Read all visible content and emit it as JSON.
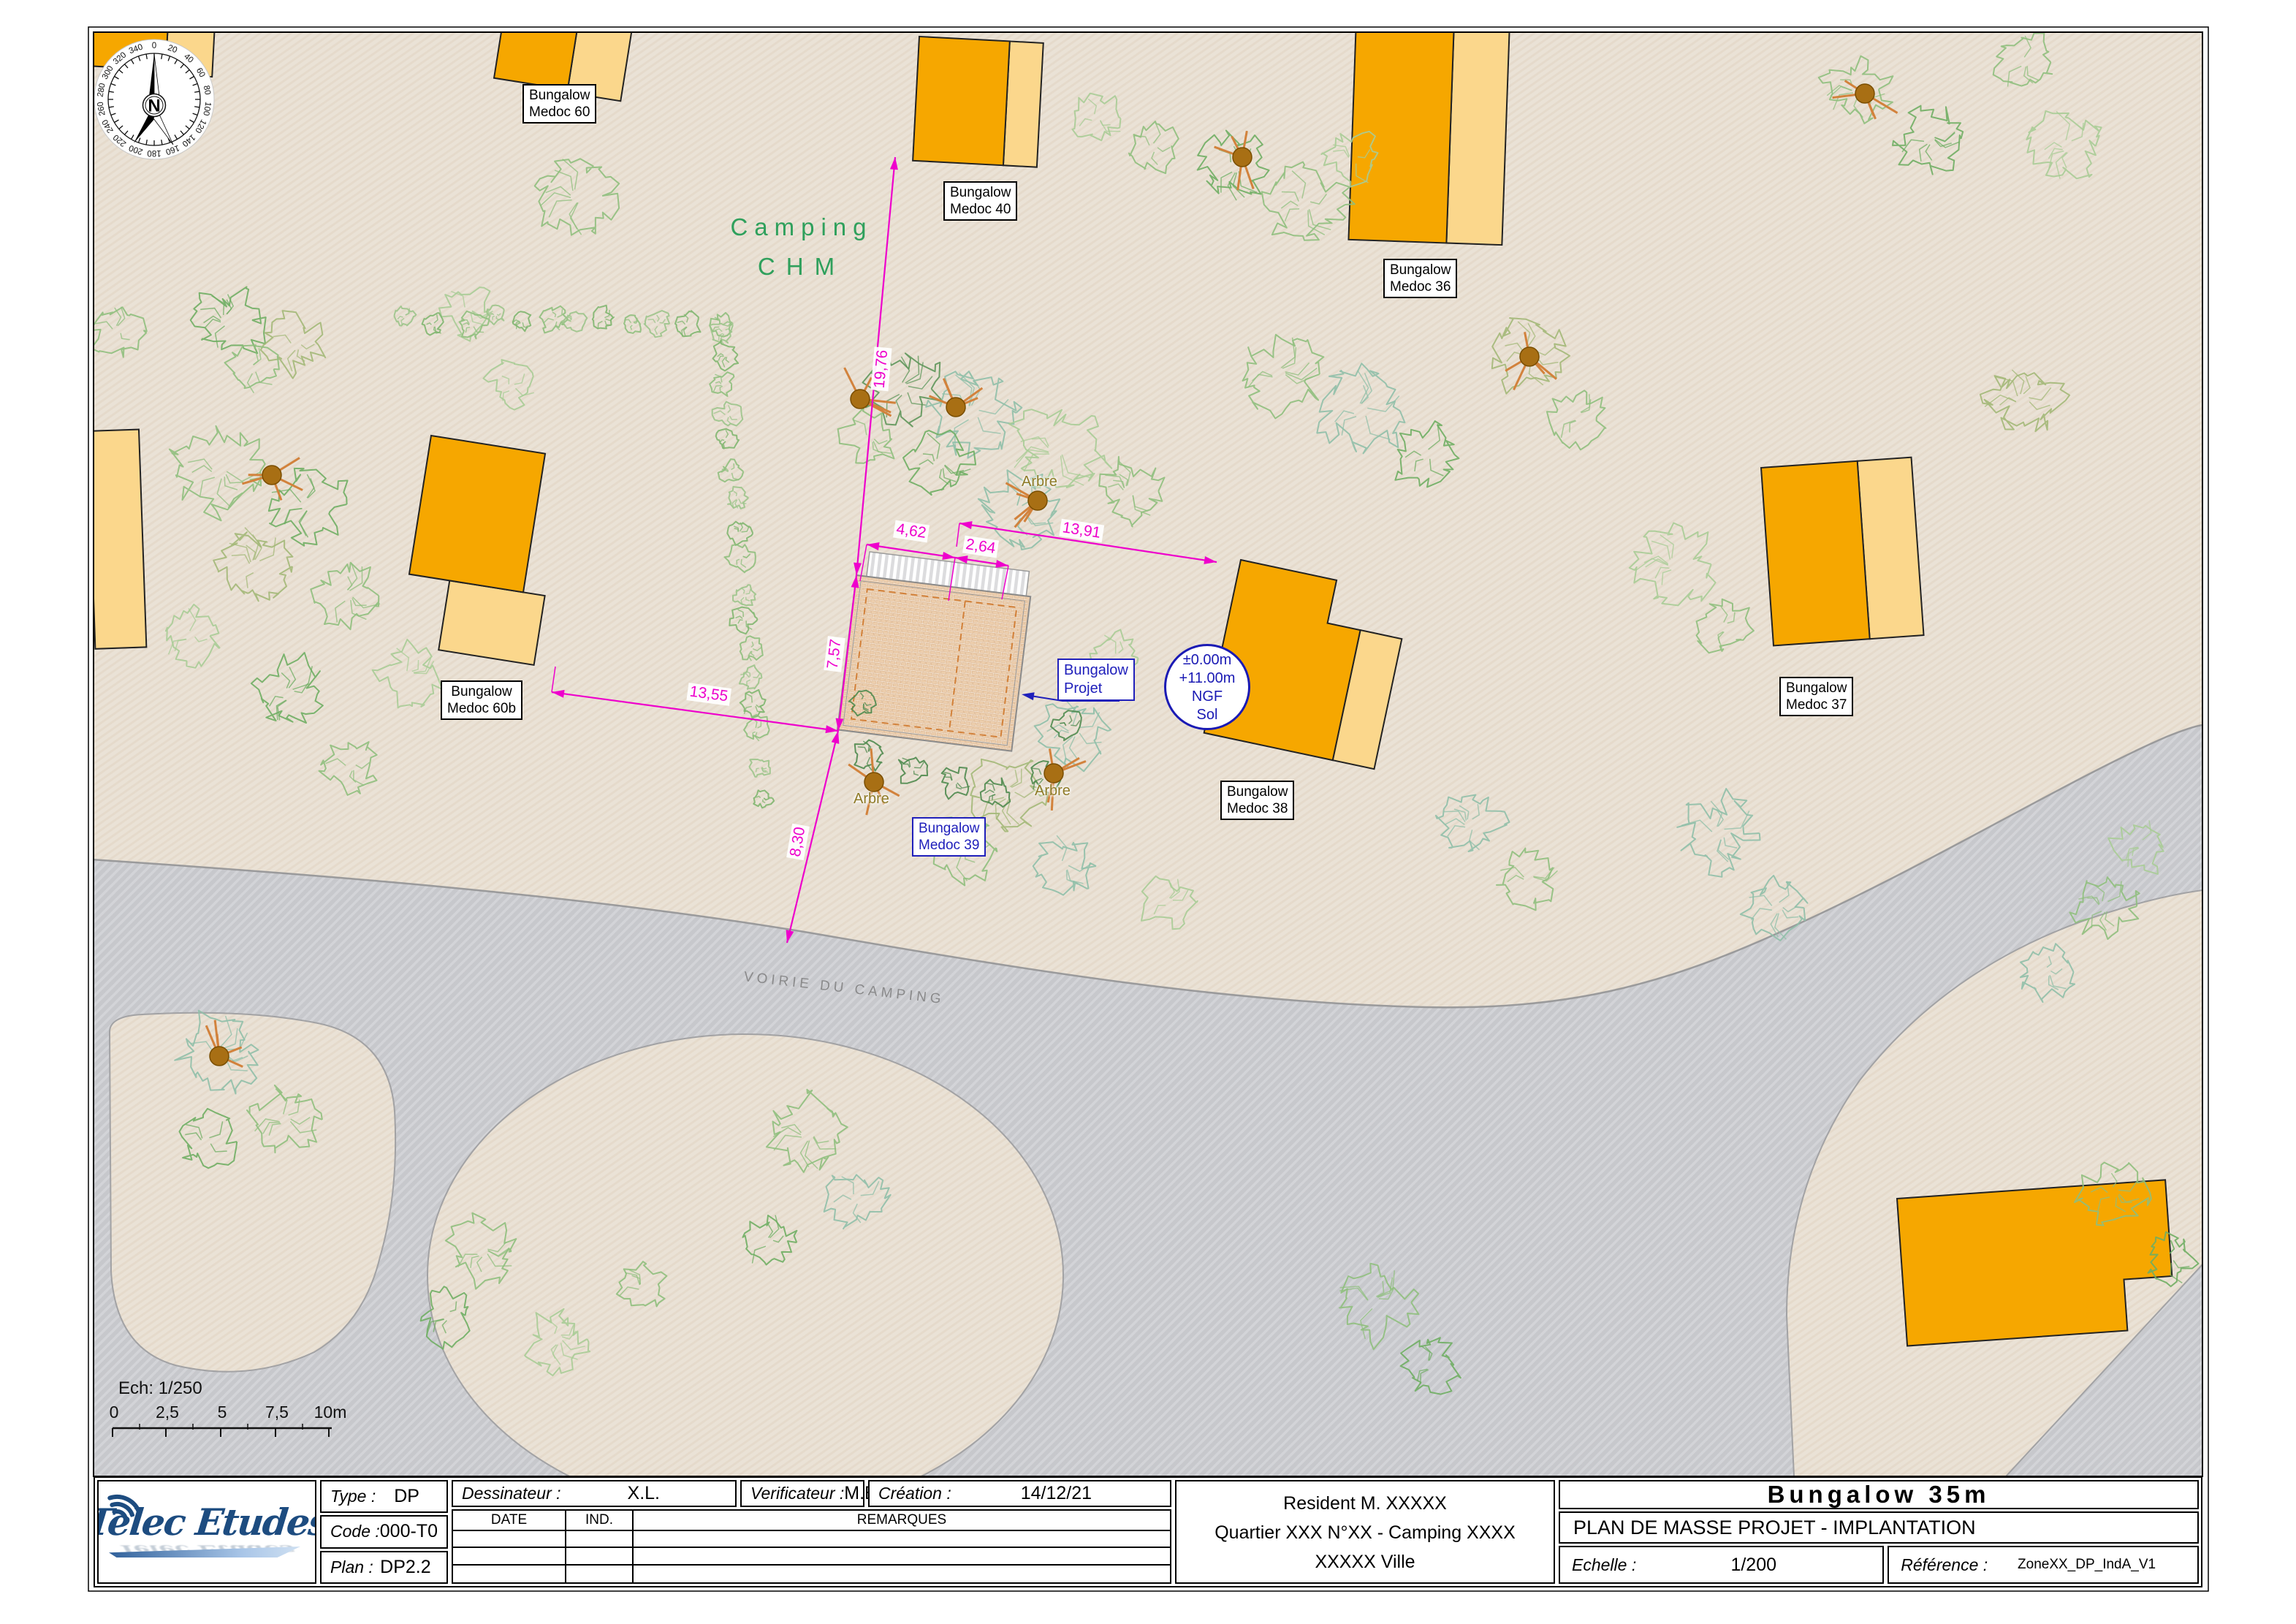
{
  "compass": {
    "north": "N",
    "degree_labels": [
      "0",
      "20",
      "40",
      "60",
      "80",
      "100",
      "120",
      "140",
      "160",
      "180",
      "200",
      "220",
      "240",
      "260",
      "280",
      "300",
      "320",
      "340"
    ]
  },
  "map": {
    "camping_line1": "Camping",
    "camping_line2": "CHM",
    "road_label": "VOIRIE DU CAMPING",
    "tree_label": "Arbre",
    "project_label": {
      "line1": "Bungalow",
      "line2": "Projet"
    },
    "level_badge": {
      "line1": "±0.00m",
      "line2": "+11.00m",
      "line3": "NGF",
      "line4": "Sol"
    },
    "bungalow_labels": [
      {
        "line1": "Bungalow",
        "line2": "Medoc 60"
      },
      {
        "line1": "Bungalow",
        "line2": "Medoc 40"
      },
      {
        "line1": "Bungalow",
        "line2": "Medoc 36"
      },
      {
        "line1": "Bungalow",
        "line2": "Medoc 60b"
      },
      {
        "line1": "Bungalow",
        "line2": "Medoc 37"
      },
      {
        "line1": "Bungalow",
        "line2": "Medoc 38"
      },
      {
        "line1": "Bungalow",
        "line2": "Medoc 39"
      }
    ],
    "dimensions": {
      "v19_76": "19,76",
      "v4_62": "4,62",
      "v2_64": "2,64",
      "v13_91": "13,91",
      "v7_57": "7,57",
      "v8_30": "8,30",
      "v13_55": "13,55"
    }
  },
  "scale_bar": {
    "label": "Ech: 1/250",
    "ticks": [
      "0",
      "2,5",
      "5",
      "7,5",
      "10m"
    ]
  },
  "title_block": {
    "logo_text": "Telec Etudes",
    "type_label": "Type :",
    "type_value": "DP",
    "code_label": "Code :",
    "code_value": "000-T0",
    "plan_label": "Plan :",
    "plan_value": "DP2.2",
    "dessinateur_label": "Dessinateur :",
    "dessinateur_value": "X.L.",
    "verificateur_label": "Verificateur :",
    "verificateur_value": "M.B.",
    "creation_label": "Création :",
    "creation_value": "14/12/21",
    "rev_col_date": "DATE",
    "rev_col_ind": "IND.",
    "rev_col_remarques": "REMARQUES",
    "client_line1": "Resident M. XXXXX",
    "client_line2": "Quartier XXX N°XX - Camping XXXX",
    "client_line3": "XXXXX Ville",
    "doc_title": "Bungalow 35m",
    "doc_subtitle": "PLAN DE MASSE PROJET - IMPLANTATION",
    "echelle_label": "Echelle :",
    "echelle_value": "1/200",
    "reference_label": "Référence :",
    "reference_value": "ZoneXX_DP_IndA_V1"
  },
  "colors": {
    "building_orange": "#F6A700",
    "building_light": "#FBD78C",
    "dimension_magenta": "#EE00CC",
    "annotation_blue": "#2020BB",
    "camping_green": "#2FA05C",
    "road_gray": "#C7C8CC",
    "ground_beige": "#EAE2D6"
  }
}
